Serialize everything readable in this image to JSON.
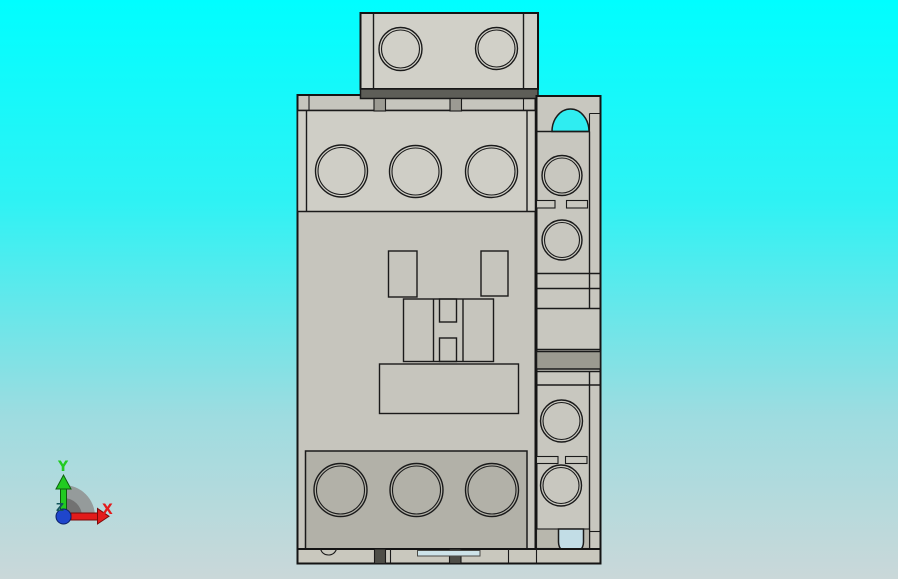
{
  "scene": {
    "description": "3D CAD viewport preview of a contactor (motor starter) model, front orthographic view on cyan gradient background",
    "background": {
      "top": "#00feff",
      "upper": "#2ff2f4",
      "lower": "#9edce0",
      "bottom": "#cad8d9"
    }
  },
  "axis_triad": {
    "x_label": "X",
    "y_label": "Y",
    "z_label": "Z",
    "x_color": "#e31b1b",
    "y_color": "#21cb21",
    "z_color": "#14555c",
    "origin_color": "#1f46cc",
    "shadow_outer": "#8f8f8f",
    "shadow_inner": "#6e6e6e"
  },
  "model": {
    "name": "contactor",
    "colors": {
      "outline": "#141414",
      "body": "#c6c5bd",
      "top_block": "#d1d0c8",
      "top_face": "#cfcec6",
      "bottom_panel": "#b2b1a8",
      "hole_face": "#c3c2ba",
      "base_strip": "#c9c8be",
      "column": "#c8c7bf",
      "dark_band": "#5e5e58",
      "column_band": "#9b9a90",
      "tab": "#9c9b93",
      "clip": "#4e4e48",
      "slot": "#cde3e9",
      "recess": "#b8b7ad",
      "hole_top": "#2fedf1",
      "hole_bottom": "#c2dde6"
    }
  }
}
